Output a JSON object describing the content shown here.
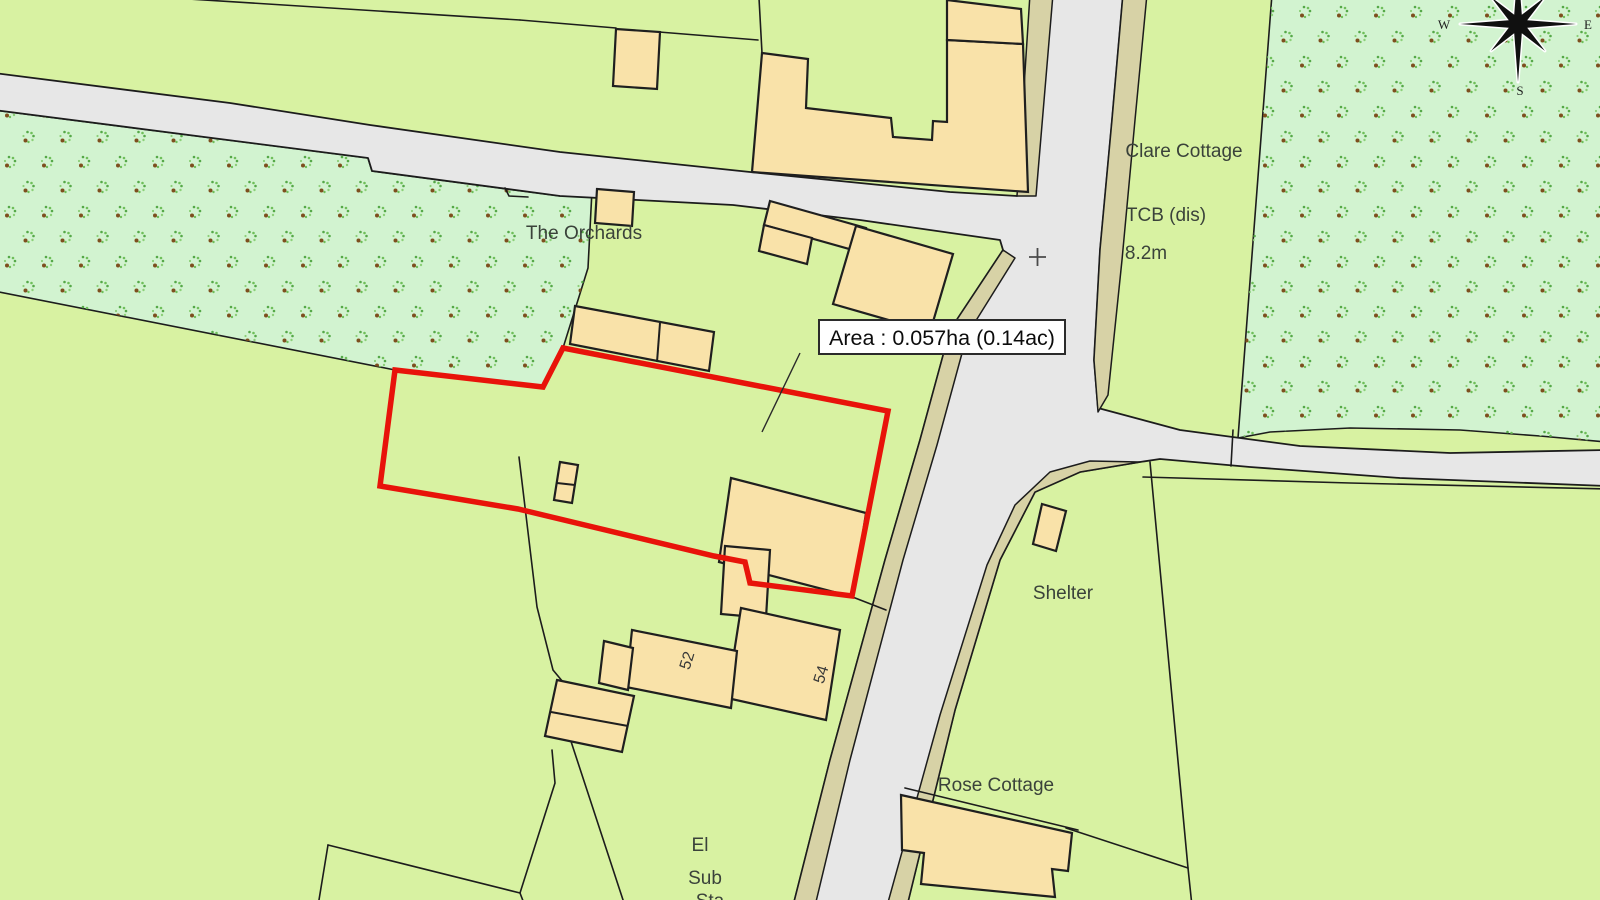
{
  "colors": {
    "field": "#d8f2a2",
    "orchard": "#d2f3d0",
    "road": "#e7e7e7",
    "verge": "#d7d2a6",
    "building": "#f9e2a9",
    "outline": "#1c1c1c",
    "plotred": "#e8130a",
    "label": "#3a423a"
  },
  "plot": {
    "area_label": "Area : 0.057ha (0.14ac)"
  },
  "labels": {
    "the_orchards": "The Orchards",
    "clare_cottage": "Clare Cottage",
    "tcb": "TCB (dis)",
    "spot_height": "8.2m",
    "shelter": "Shelter",
    "rose_cottage": "Rose Cottage",
    "el_line1": "El",
    "el_line2": "Sub",
    "el_line3": "Sta",
    "house_52": "52",
    "house_54": "54"
  },
  "compass": {
    "west": "W",
    "east": "E",
    "south": "S"
  }
}
